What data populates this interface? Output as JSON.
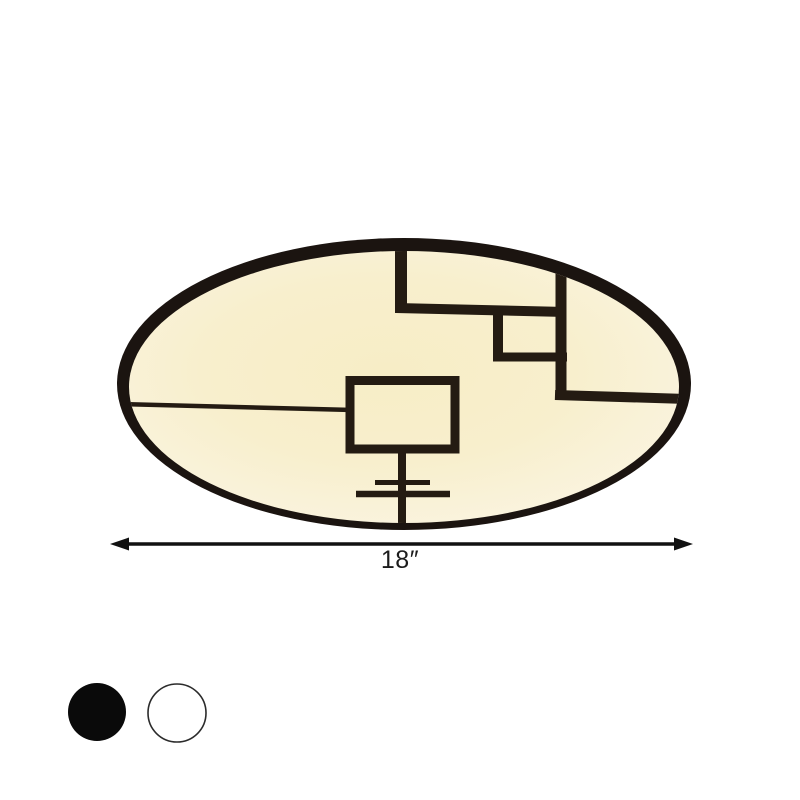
{
  "product_photo": {
    "description": "Round flush mount ceiling light with black rim and warm illuminated panel decorated with black geometric line pattern",
    "lamp": {
      "rim_color": "#1b1410",
      "pattern_color": "#241b12",
      "face_color_center": "#f7edc6",
      "face_color_mid": "#f8efcd",
      "face_color_edge": "#faf4e0"
    }
  },
  "dimension": {
    "label": "18″",
    "arrow_color": "#111111"
  },
  "swatches": [
    {
      "name": "black",
      "color": "#0a0a0a"
    },
    {
      "name": "white",
      "color": "#ffffff",
      "border_color": "#2b2b2b"
    }
  ]
}
